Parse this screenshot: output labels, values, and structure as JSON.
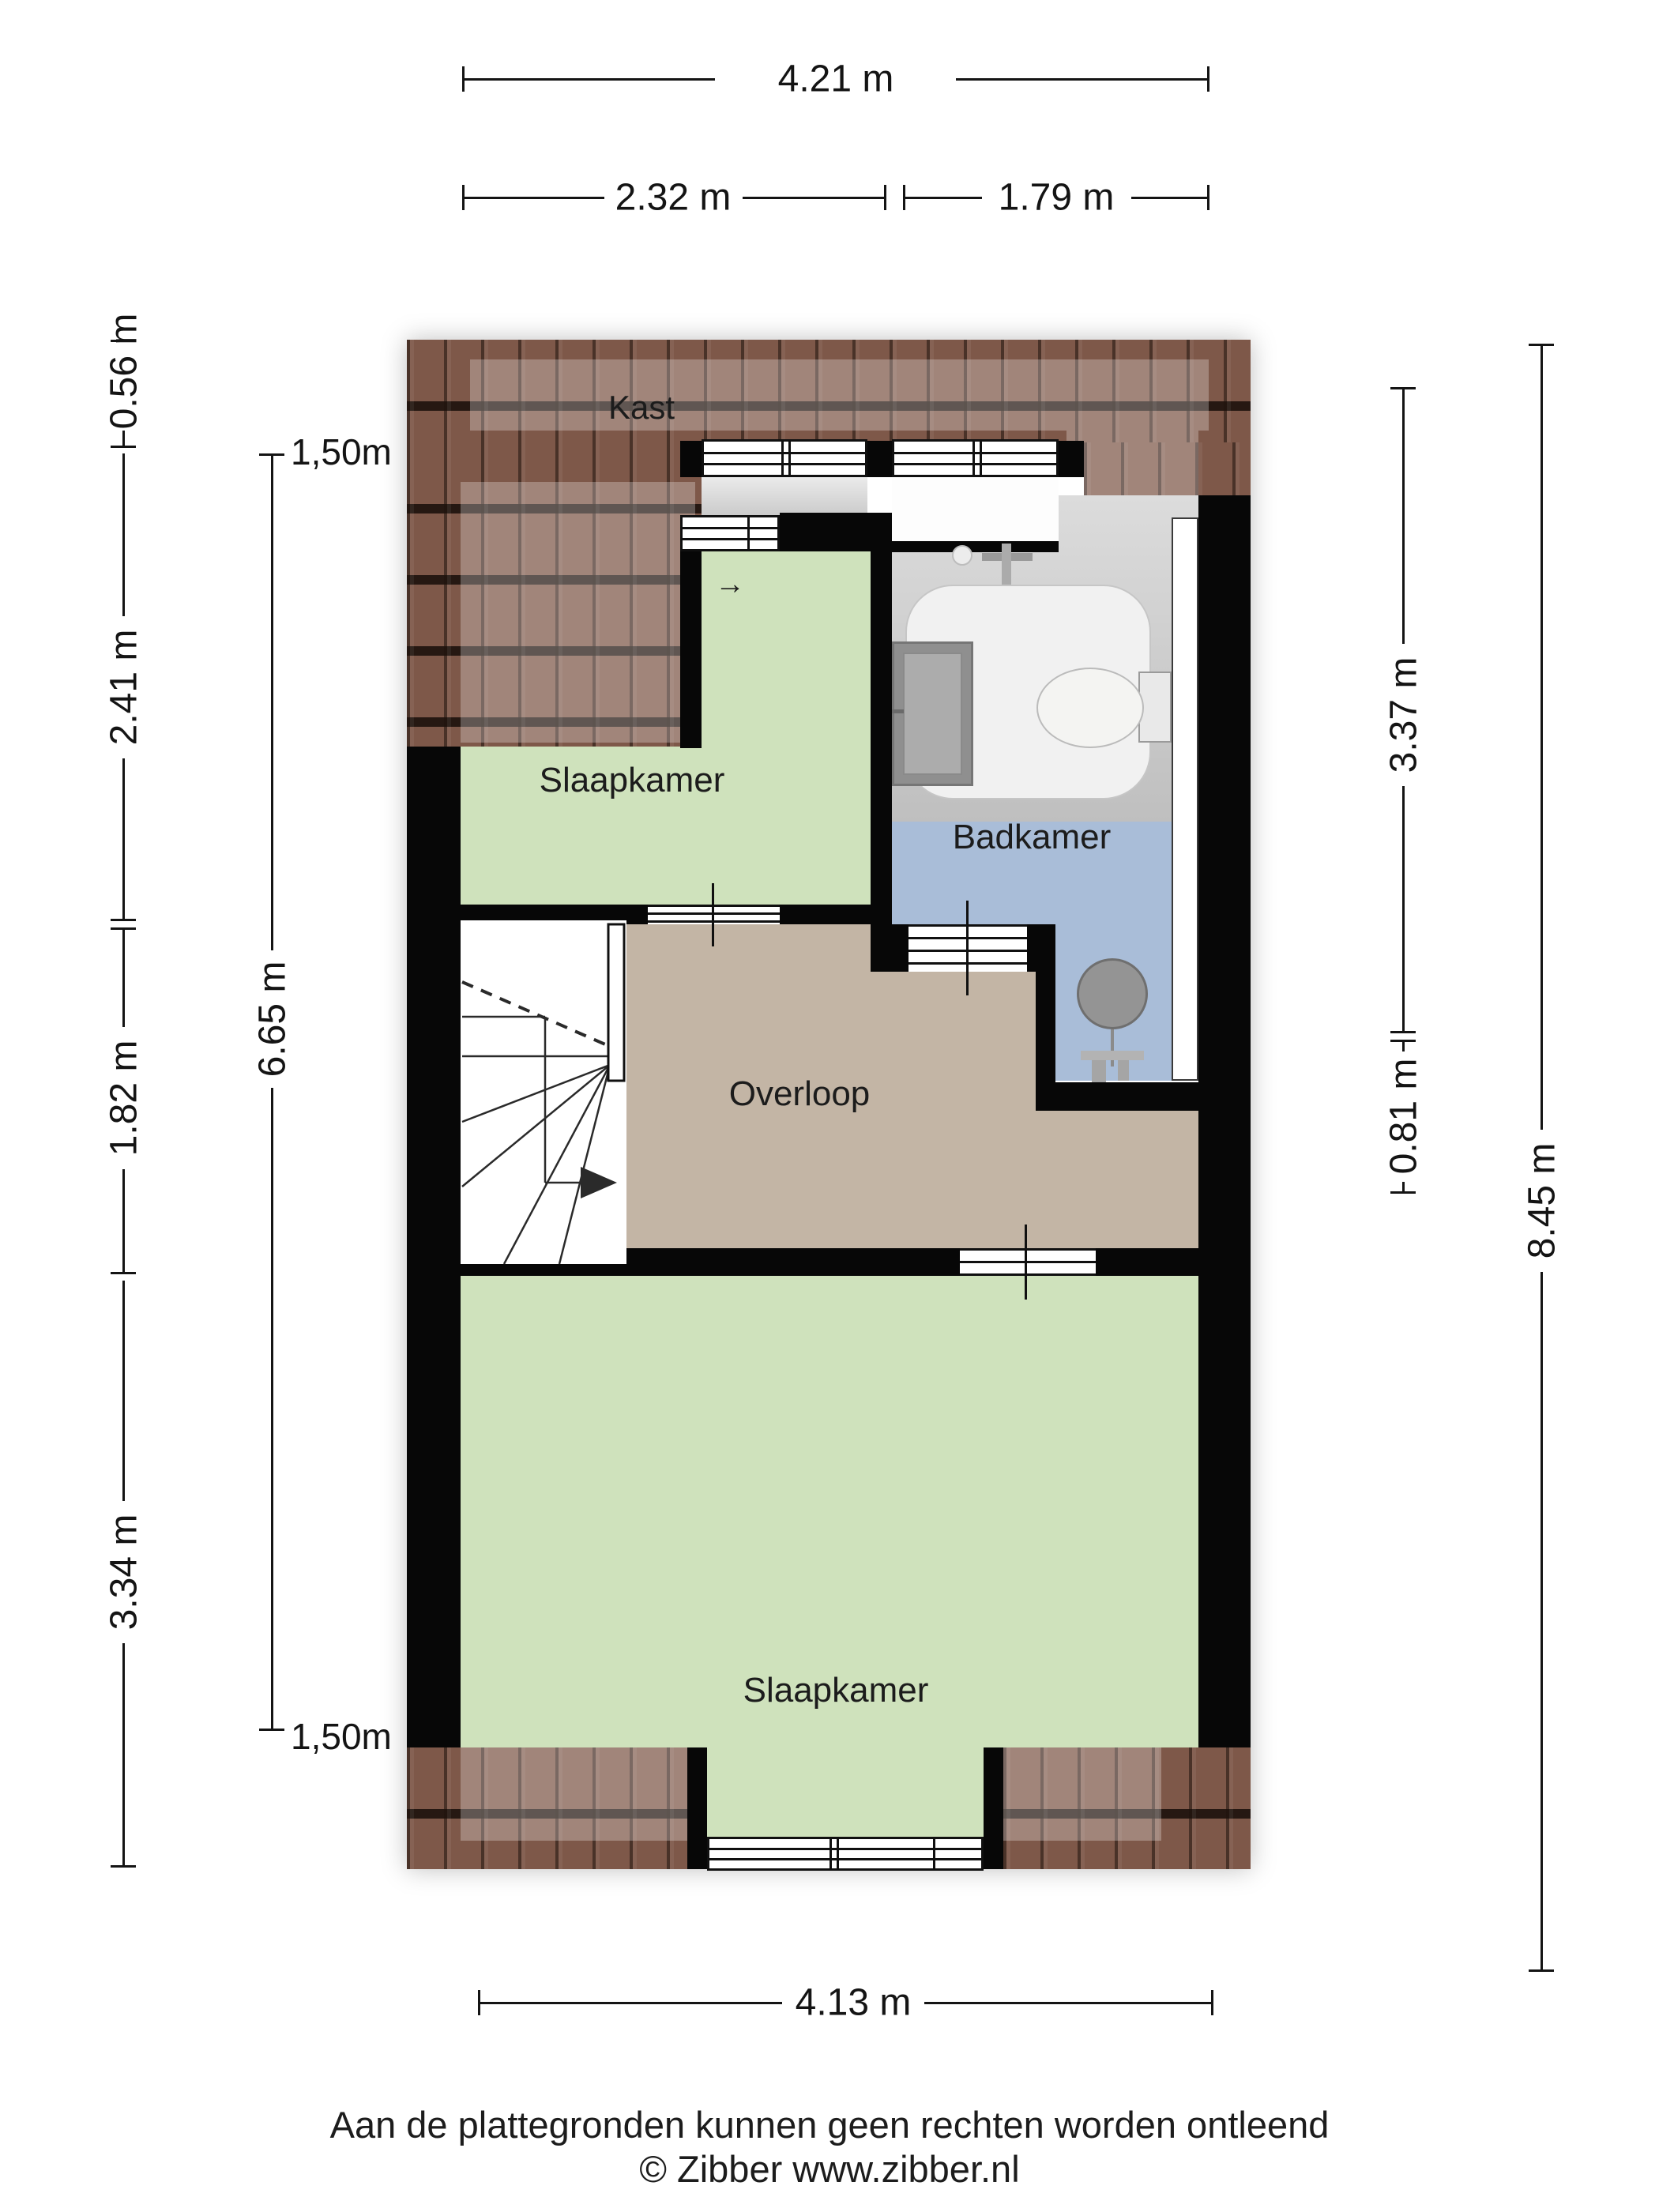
{
  "rooms": {
    "kast": {
      "label": "Kast"
    },
    "bedroom_top": {
      "label": "Slaapkamer"
    },
    "bathroom": {
      "label": "Badkamer"
    },
    "landing": {
      "label": "Overloop"
    },
    "bedroom_bottom": {
      "label": "Slaapkamer"
    }
  },
  "icons": {
    "door_arrow": "→"
  },
  "dimensions": {
    "top_total": {
      "label": "4.21 m"
    },
    "top_left": {
      "label": "2.32 m"
    },
    "top_right": {
      "label": "1.79 m"
    },
    "left_outer": [
      {
        "label": "0.56 m"
      },
      {
        "label": "2.41 m"
      },
      {
        "label": "1.82 m"
      },
      {
        "label": "3.34 m"
      }
    ],
    "left_inner": {
      "top_marker": "1,50m",
      "length": "6.65 m",
      "bottom_marker": "1,50m"
    },
    "right_inner": [
      {
        "label": "3.37 m"
      },
      {
        "label": "0.81 m"
      }
    ],
    "right_outer": {
      "label": "8.45 m"
    },
    "bottom_total": {
      "label": "4.13 m"
    }
  },
  "footer": {
    "line1": "Aan de plattegronden kunnen geen rechten worden ontleend",
    "line2": "© Zibber www.zibber.nl"
  },
  "colors": {
    "room_green": "#cfe2bc",
    "room_blue": "#a9bdd8",
    "room_tan": "#c3b5a5",
    "roof_brown": "#7e5849",
    "wall_black": "#070707"
  }
}
